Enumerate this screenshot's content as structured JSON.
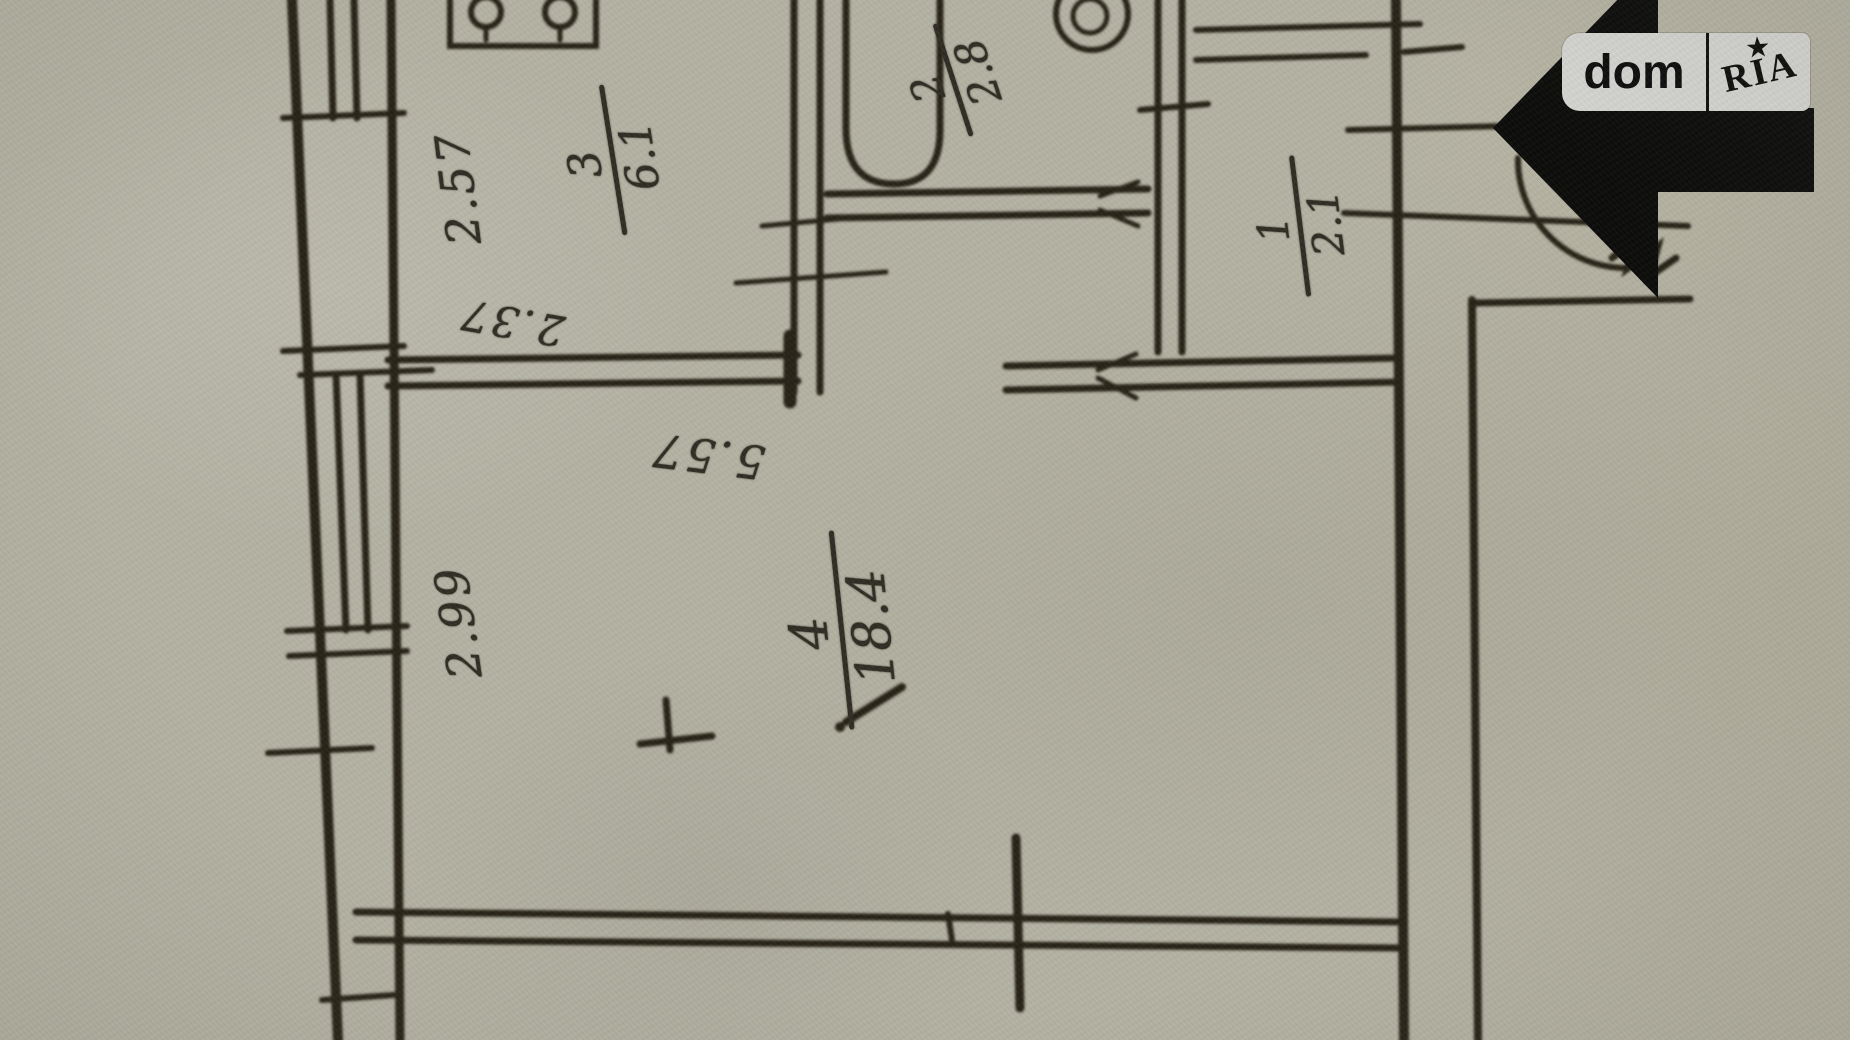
{
  "watermark": {
    "brand_left": "dom",
    "brand_right": "RIA",
    "star_icon": "★"
  },
  "plan": {
    "rooms": [
      {
        "number": "1",
        "area": "2.1"
      },
      {
        "number": "2",
        "area": "2.8"
      },
      {
        "number": "3",
        "area": "6.1"
      },
      {
        "number": "4",
        "area": "18.4"
      }
    ],
    "dimensions": [
      {
        "value": "2.57"
      },
      {
        "value": "2.37"
      },
      {
        "value": "5.57"
      },
      {
        "value": "2.99"
      }
    ]
  }
}
